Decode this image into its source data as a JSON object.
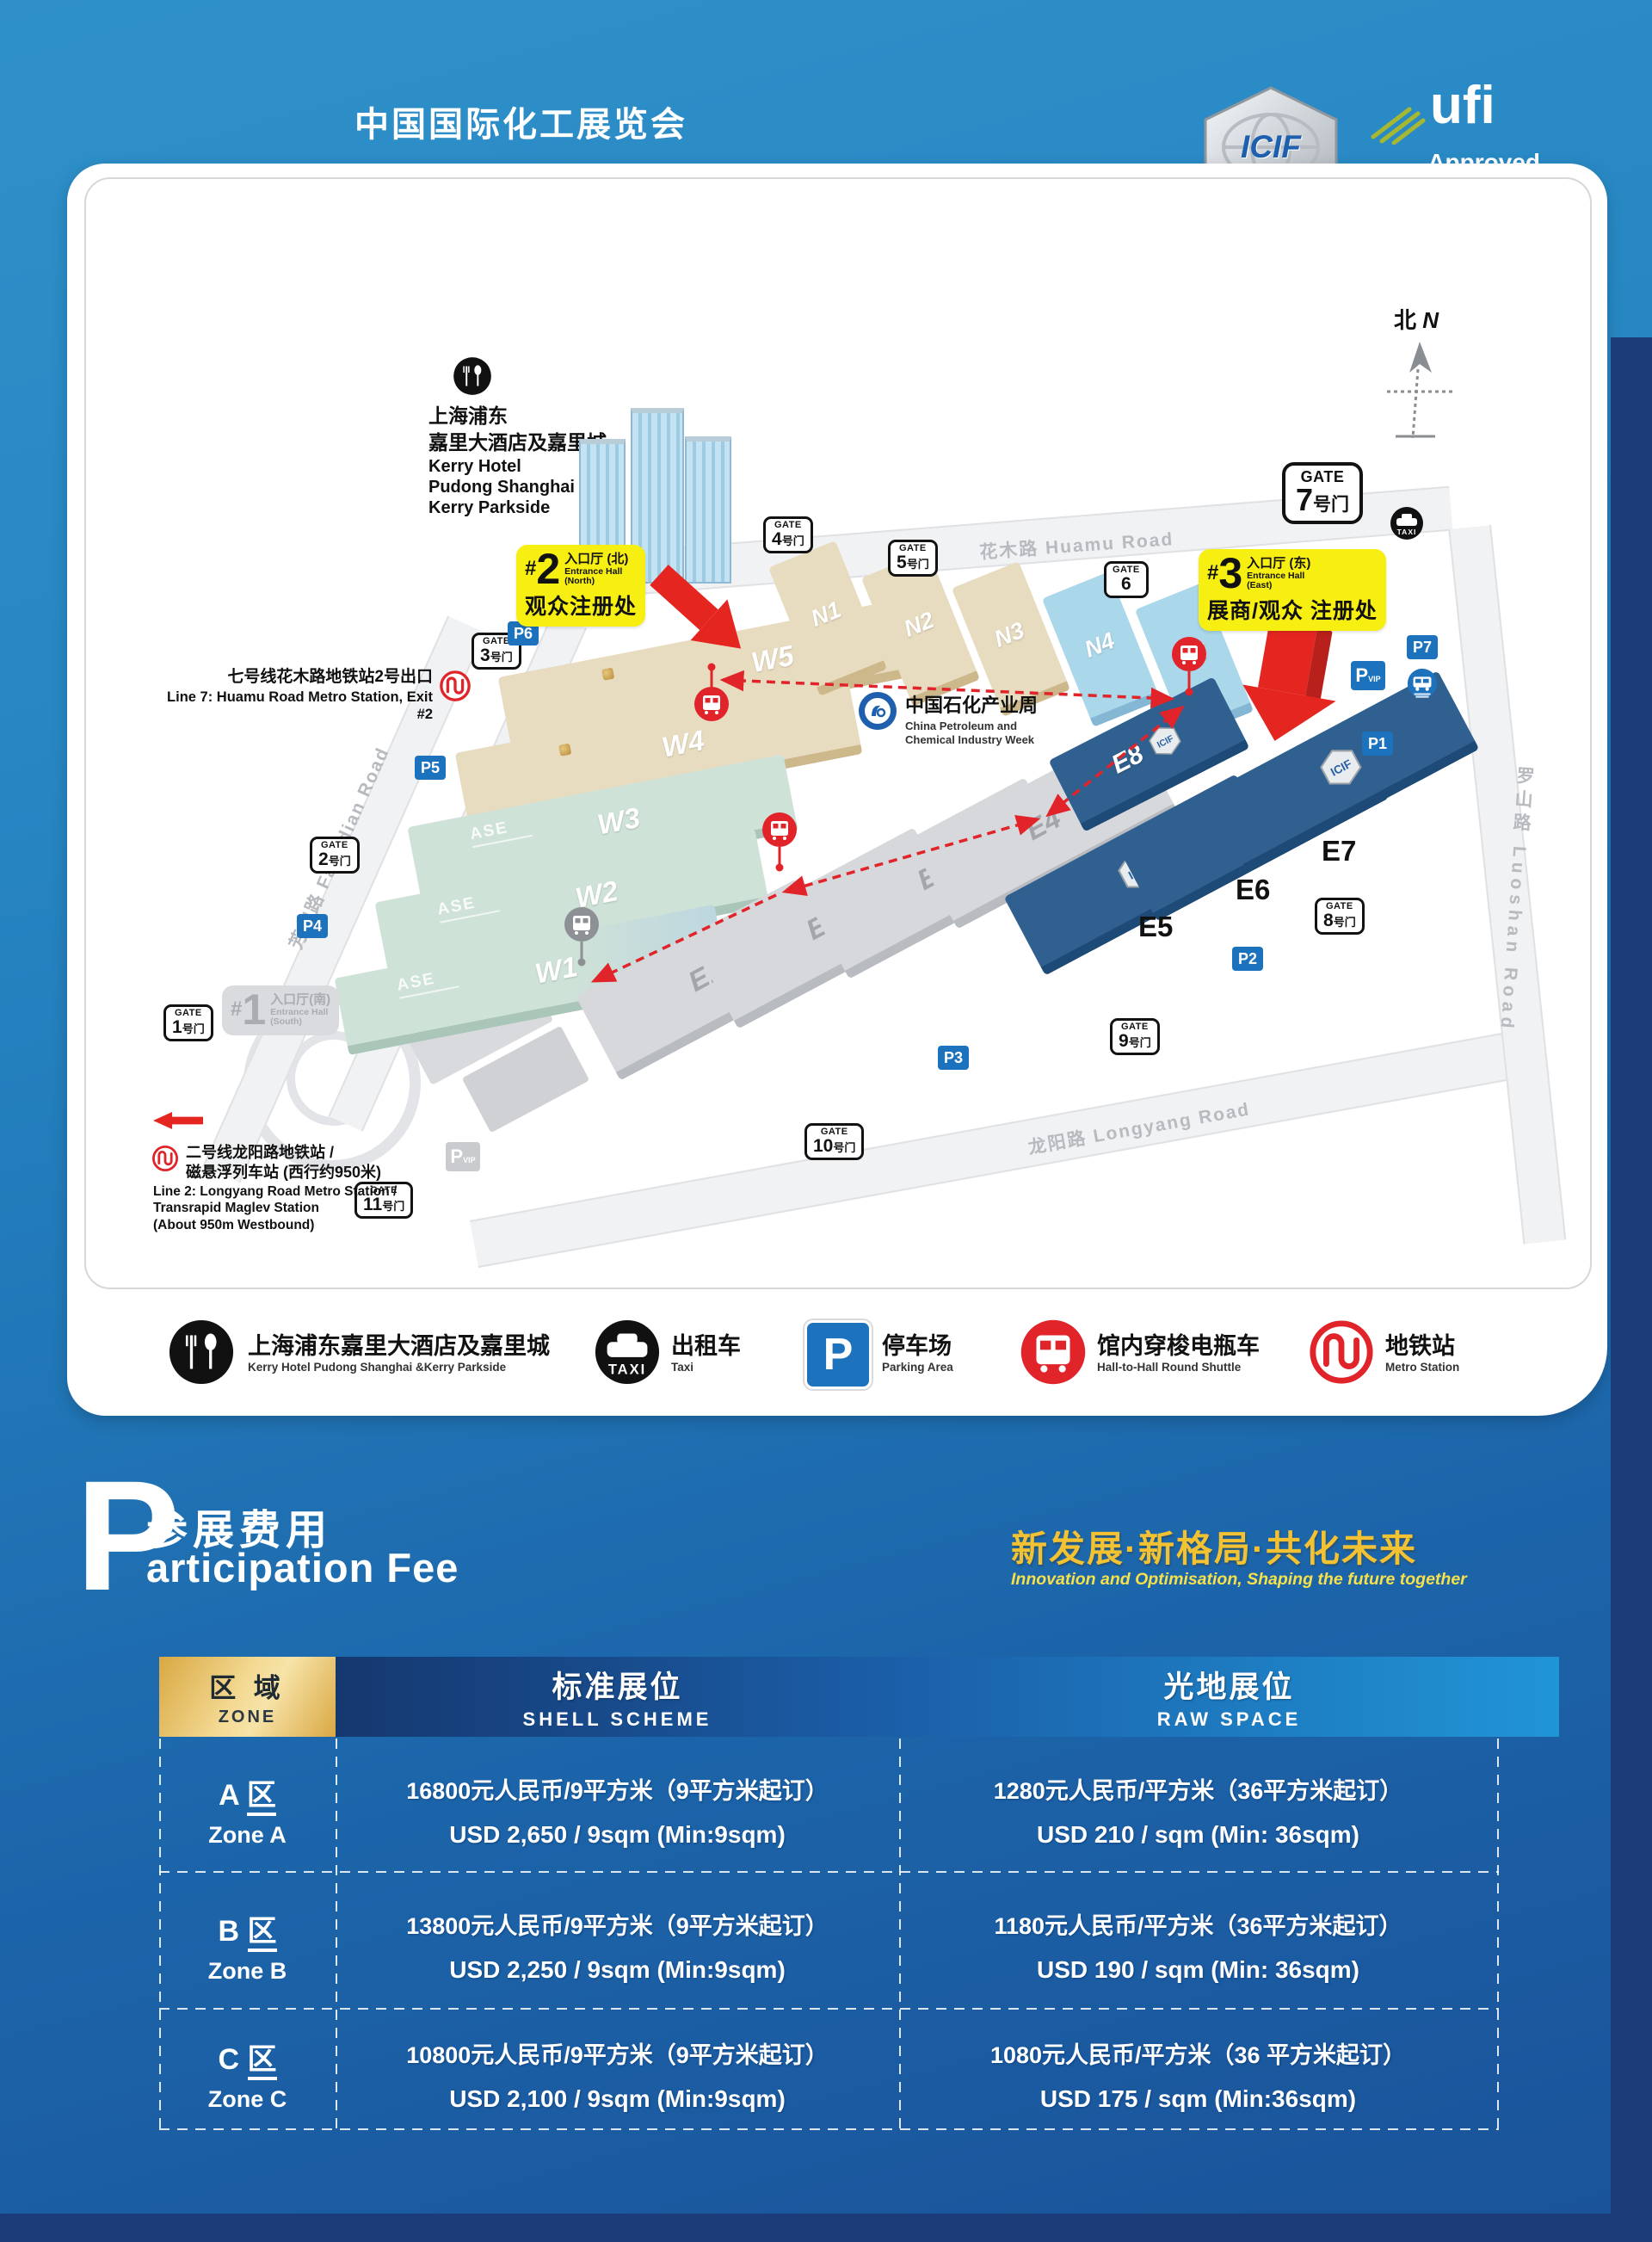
{
  "page": {
    "title": "中国国际化工展览会",
    "logos": {
      "icif": {
        "text": "ICIF",
        "sub": "CHINA"
      },
      "ufi": {
        "name": "ufi",
        "line1": "Approved",
        "line2": "Event"
      }
    }
  },
  "map": {
    "compass": {
      "zh": "北",
      "en": "N"
    },
    "kerry": {
      "zh1": "上海浦东",
      "zh2": "嘉里大酒店及嘉里城",
      "en1": "Kerry Hotel",
      "en2": "Pudong Shanghai &",
      "en3": "Kerry Parkside"
    },
    "entrance2": {
      "hash": "#",
      "num": "2",
      "zh": "入口厅 (北)",
      "en1": "Entrance Hall",
      "en2": "(North)",
      "line2": "观众注册处"
    },
    "entrance3": {
      "hash": "#",
      "num": "3",
      "zh": "入口厅 (东)",
      "en1": "Entrance Hall",
      "en2": "(East)",
      "line2": "展商/观众 注册处"
    },
    "entrance1": {
      "hash": "#",
      "num": "1",
      "zh": "入口厅(南)",
      "en1": "Entrance Hall",
      "en2": "(South)"
    },
    "gate_word": "GATE",
    "gate_suffix": "号门",
    "gates": [
      "1",
      "2",
      "3",
      "4",
      "5",
      "6",
      "7",
      "8",
      "9",
      "10",
      "11"
    ],
    "parking": [
      "P1",
      "P2",
      "P3",
      "P4",
      "P5",
      "P6",
      "P7"
    ],
    "p_vip": {
      "p": "P",
      "vip": "VIP"
    },
    "taxi": "TAXI",
    "roads": {
      "huamu": "花木路  Huamu Road",
      "fangdian": "芳甸路  Fangdian Road",
      "longyang": "龙阳路  Longyang Road",
      "luoshan": "罗山路  Luoshan Road"
    },
    "metro7": {
      "zh": "七号线花木路地铁站2号出口",
      "en": "Line 7: Huamu Road Metro Station, Exit #2"
    },
    "metro2": {
      "zh1": "二号线龙阳路地铁站 /",
      "zh2": "磁悬浮列车站 (西行约950米)",
      "en1": "Line 2: Longyang Road Metro Station /",
      "en2": "Transrapid Maglev Station",
      "en3": "(About 950m Westbound)"
    },
    "cpciw": {
      "zh": "中国石化产业周",
      "en1": "China Petroleum and",
      "en2": "Chemical Industry Week"
    },
    "halls": {
      "w": [
        "W5",
        "W4",
        "W3",
        "W2",
        "W1"
      ],
      "n": [
        "N1",
        "N2",
        "N3",
        "N4",
        "N5"
      ],
      "eg": [
        "E1",
        "E2",
        "E3",
        "E4"
      ],
      "eb": [
        "E5",
        "E6",
        "E7"
      ],
      "e8": "E8"
    },
    "ase": "ASE"
  },
  "legend": {
    "items": [
      {
        "zh": "上海浦东嘉里大酒店及嘉里城",
        "en": "Kerry Hotel Pudong Shanghai &Kerry Parkside"
      },
      {
        "zh": "出租车",
        "en": "Taxi"
      },
      {
        "zh": "停车场",
        "en": "Parking Area"
      },
      {
        "zh": "馆内穿梭电瓶车",
        "en": "Hall-to-Hall Round Shuttle"
      },
      {
        "zh": "地铁站",
        "en": "Metro Station"
      }
    ]
  },
  "fee": {
    "p": "P",
    "zh": "参展费用",
    "en": "articipation Fee",
    "slogan_zh": "新发展·新格局·共化未来",
    "slogan_en": "Innovation and Optimisation, Shaping the future together"
  },
  "table": {
    "zone_header": {
      "zh": "区 域",
      "en": "ZONE"
    },
    "col1": {
      "zh": "标准展位",
      "en": "SHELL SCHEME"
    },
    "col2": {
      "zh": "光地展位",
      "en": "RAW SPACE"
    },
    "qu": "区",
    "rows": [
      {
        "letter": "A",
        "zone_en": "Zone A",
        "shell_cny": "16800元人民币/9平方米（9平方米起订）",
        "shell_usd": "USD 2,650 / 9sqm (Min:9sqm)",
        "raw_cny": "1280元人民币/平方米（36平方米起订）",
        "raw_usd": "USD 210 / sqm (Min: 36sqm)"
      },
      {
        "letter": "B",
        "zone_en": "Zone B",
        "shell_cny": "13800元人民币/9平方米（9平方米起订）",
        "shell_usd": "USD 2,250 / 9sqm (Min:9sqm)",
        "raw_cny": "1180元人民币/平方米（36平方米起订）",
        "raw_usd": "USD 190 / sqm (Min: 36sqm)"
      },
      {
        "letter": "C",
        "zone_en": "Zone C",
        "shell_cny": "10800元人民币/9平方米（9平方米起订）",
        "shell_usd": "USD 2,100 / 9sqm (Min:9sqm)",
        "raw_cny": "1080元人民币/平方米（36 平方米起订）",
        "raw_usd": "USD 175 / sqm (Min:36sqm)"
      }
    ]
  }
}
